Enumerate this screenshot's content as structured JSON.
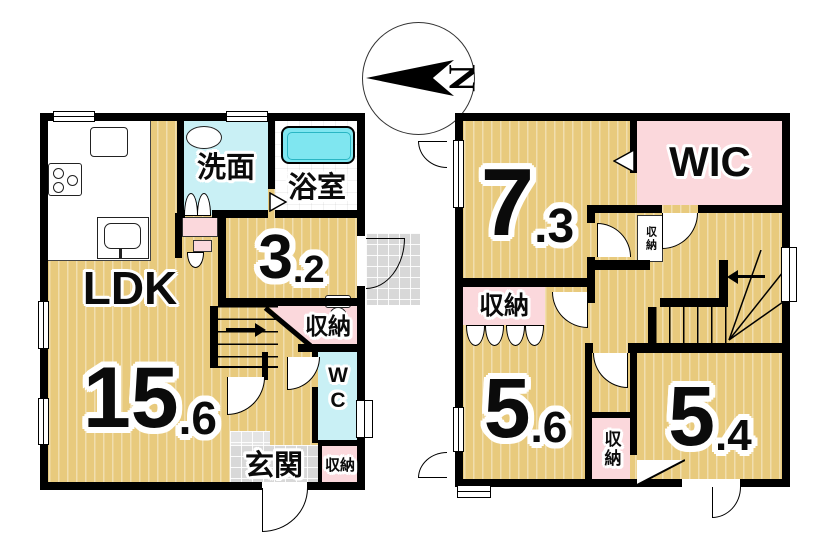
{
  "compass": {
    "north_label": "N"
  },
  "floor1": {
    "ldk": {
      "label": "LDK",
      "size_int": "15",
      "size_frac": ".6"
    },
    "washroom": {
      "label": "洗面"
    },
    "bathroom": {
      "label": "浴室"
    },
    "room_3_2": {
      "size_int": "3",
      "size_frac": ".2"
    },
    "closet_mid": {
      "label": "収納"
    },
    "wc": {
      "label": "WC"
    },
    "entrance": {
      "label": "玄関"
    },
    "closet_entrance": {
      "label": "収納"
    }
  },
  "floor2": {
    "room_7_3": {
      "size_int": "7",
      "size_frac": ".3"
    },
    "wic": {
      "label": "WIC"
    },
    "closet_tiny": {
      "label": "収納"
    },
    "closet_left": {
      "label": "収納"
    },
    "room_5_6": {
      "size_int": "5",
      "size_frac": ".6"
    },
    "closet_mid": {
      "label": "収納"
    },
    "room_5_4": {
      "size_int": "5",
      "size_frac": ".4"
    }
  },
  "colors": {
    "floor_tan": "#e8ca7d",
    "closet_pink": "#fbd8dc",
    "wet_cyan": "#c9f0f5",
    "tub_cyan": "#7fe6f0",
    "tile_gray": "#d8d8d8",
    "wall": "#000000"
  }
}
